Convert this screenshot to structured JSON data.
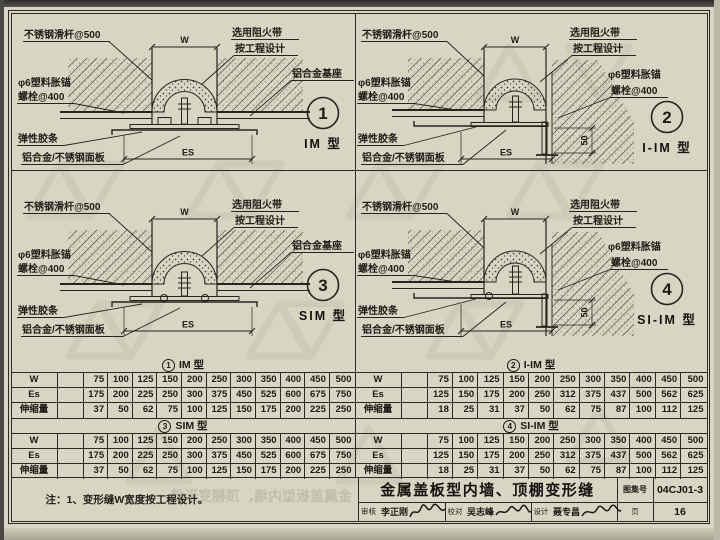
{
  "page": {
    "paper_color": "#d9d5c3",
    "ink_color": "#26241f",
    "watermark_color": "#c3bfae"
  },
  "diagrams": [
    {
      "number": "1",
      "type": "IM 型",
      "dims": {
        "top": "W",
        "bottom": "ES"
      },
      "labels": {
        "slide_rod": "不锈钢滑杆@500",
        "anchor1": "φ6塑料胀锚",
        "anchor2": "螺栓@400",
        "fire1": "选用阻火带",
        "fire2": "按工程设计",
        "base": "铝合金基座",
        "rubber": "弹性胶条",
        "panel": "铝合金/不锈钢面板"
      }
    },
    {
      "number": "2",
      "type": "I-IM 型",
      "dims": {
        "top": "W",
        "bottom": "ES",
        "side": "50"
      },
      "labels": {
        "slide_rod": "不锈钢滑杆@500",
        "anchor_l1": "φ6塑料胀锚",
        "anchor_l2": "螺栓@400",
        "fire1": "选用阻火带",
        "fire2": "按工程设计",
        "anchor_r1": "φ6塑料胀锚",
        "anchor_r2": "螺栓@400",
        "rubber": "弹性胶条",
        "panel": "铝合金/不锈钢面板"
      }
    },
    {
      "number": "3",
      "type": "SIM 型",
      "dims": {
        "top": "W",
        "bottom": "ES"
      },
      "labels": {
        "slide_rod": "不锈钢滑杆@500",
        "anchor1": "φ6塑料胀锚",
        "anchor2": "螺栓@400",
        "fire1": "选用阻火带",
        "fire2": "按工程设计",
        "base": "铝合金基座",
        "rubber": "弹性胶条",
        "panel": "铝合金/不锈钢面板"
      }
    },
    {
      "number": "4",
      "type": "SI-IM 型",
      "dims": {
        "top": "W",
        "bottom": "ES",
        "side": "50"
      },
      "labels": {
        "slide_rod": "不锈钢滑杆@500",
        "anchor_l1": "φ6塑料胀锚",
        "anchor_l2": "螺栓@400",
        "fire1": "选用阻火带",
        "fire2": "按工程设计",
        "anchor_r1": "φ6塑料胀锚",
        "anchor_r2": "螺栓@400",
        "rubber": "弹性胶条",
        "panel": "铝合金/不锈钢面板"
      }
    }
  ],
  "tables": [
    {
      "num": "1",
      "name": "IM 型",
      "rows": [
        {
          "label": "W",
          "values": [
            75,
            100,
            125,
            150,
            200,
            250,
            300,
            350,
            400,
            450,
            500
          ]
        },
        {
          "label": "Es",
          "values": [
            175,
            200,
            225,
            250,
            300,
            375,
            450,
            525,
            600,
            675,
            750
          ]
        },
        {
          "label": "伸缩量",
          "values": [
            37,
            50,
            62,
            75,
            100,
            125,
            150,
            175,
            200,
            225,
            250
          ]
        }
      ]
    },
    {
      "num": "2",
      "name": "I-IM 型",
      "rows": [
        {
          "label": "W",
          "values": [
            75,
            100,
            125,
            150,
            200,
            250,
            300,
            350,
            400,
            450,
            500
          ]
        },
        {
          "label": "Es",
          "values": [
            125,
            150,
            175,
            200,
            250,
            312,
            375,
            437,
            500,
            562,
            625
          ]
        },
        {
          "label": "伸缩量",
          "values": [
            18,
            25,
            31,
            37,
            50,
            62,
            75,
            87,
            100,
            112,
            125
          ]
        }
      ]
    },
    {
      "num": "3",
      "name": "SIM 型",
      "rows": [
        {
          "label": "W",
          "values": [
            75,
            100,
            125,
            150,
            200,
            250,
            300,
            350,
            400,
            450,
            500
          ]
        },
        {
          "label": "Es",
          "values": [
            175,
            200,
            225,
            250,
            300,
            375,
            450,
            525,
            600,
            675,
            750
          ]
        },
        {
          "label": "伸缩量",
          "values": [
            37,
            50,
            62,
            75,
            100,
            125,
            150,
            175,
            200,
            225,
            250
          ]
        }
      ]
    },
    {
      "num": "4",
      "name": "SI-IM 型",
      "rows": [
        {
          "label": "W",
          "values": [
            75,
            100,
            125,
            150,
            200,
            250,
            300,
            350,
            400,
            450,
            500
          ]
        },
        {
          "label": "Es",
          "values": [
            125,
            150,
            175,
            200,
            250,
            312,
            375,
            437,
            500,
            562,
            625
          ]
        },
        {
          "label": "伸缩量",
          "values": [
            18,
            25,
            31,
            37,
            50,
            62,
            75,
            87,
            100,
            112,
            125
          ]
        }
      ]
    }
  ],
  "footer": {
    "note": "注：1、变形缝W宽度按工程设计。",
    "ghost_text": "金属盖板型内墙、顶棚变形缝"
  },
  "title_block": {
    "title": "金属盖板型内墙、顶棚变形缝",
    "atlas_no_label": "图集号",
    "atlas_no": "04CJ01-3",
    "page_label": "页",
    "page_no": "16",
    "reviewer_label": "审核",
    "reviewer": "李正刚",
    "checker_label": "校对",
    "checker": "吴志峰",
    "designer_label": "设计",
    "designer": "聂专昌"
  }
}
